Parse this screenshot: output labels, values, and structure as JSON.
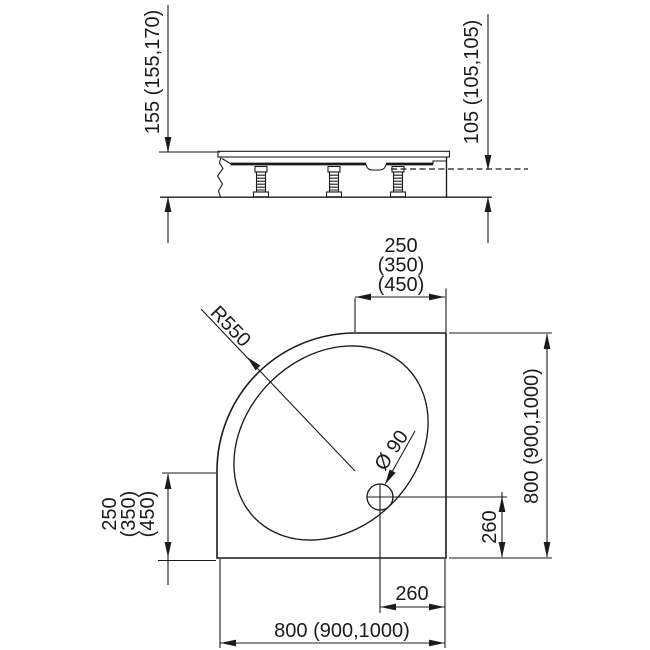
{
  "side_view": {
    "total_height": "155 (155,170)",
    "floor_height": "105 (105,105)"
  },
  "plan_view": {
    "top_offset": [
      "250",
      "(350)",
      "(450)"
    ],
    "left_offset": [
      "250",
      "(350)",
      "(450)"
    ],
    "corner_radius": "R550",
    "drain_diameter": "Ø 90",
    "width": "800 (900,1000)",
    "depth": "800 (900,1000)",
    "drain_offset_right": "260",
    "drain_offset_bottom": "260"
  },
  "colors": {
    "line": "#1b1b1b",
    "background": "#ffffff"
  }
}
